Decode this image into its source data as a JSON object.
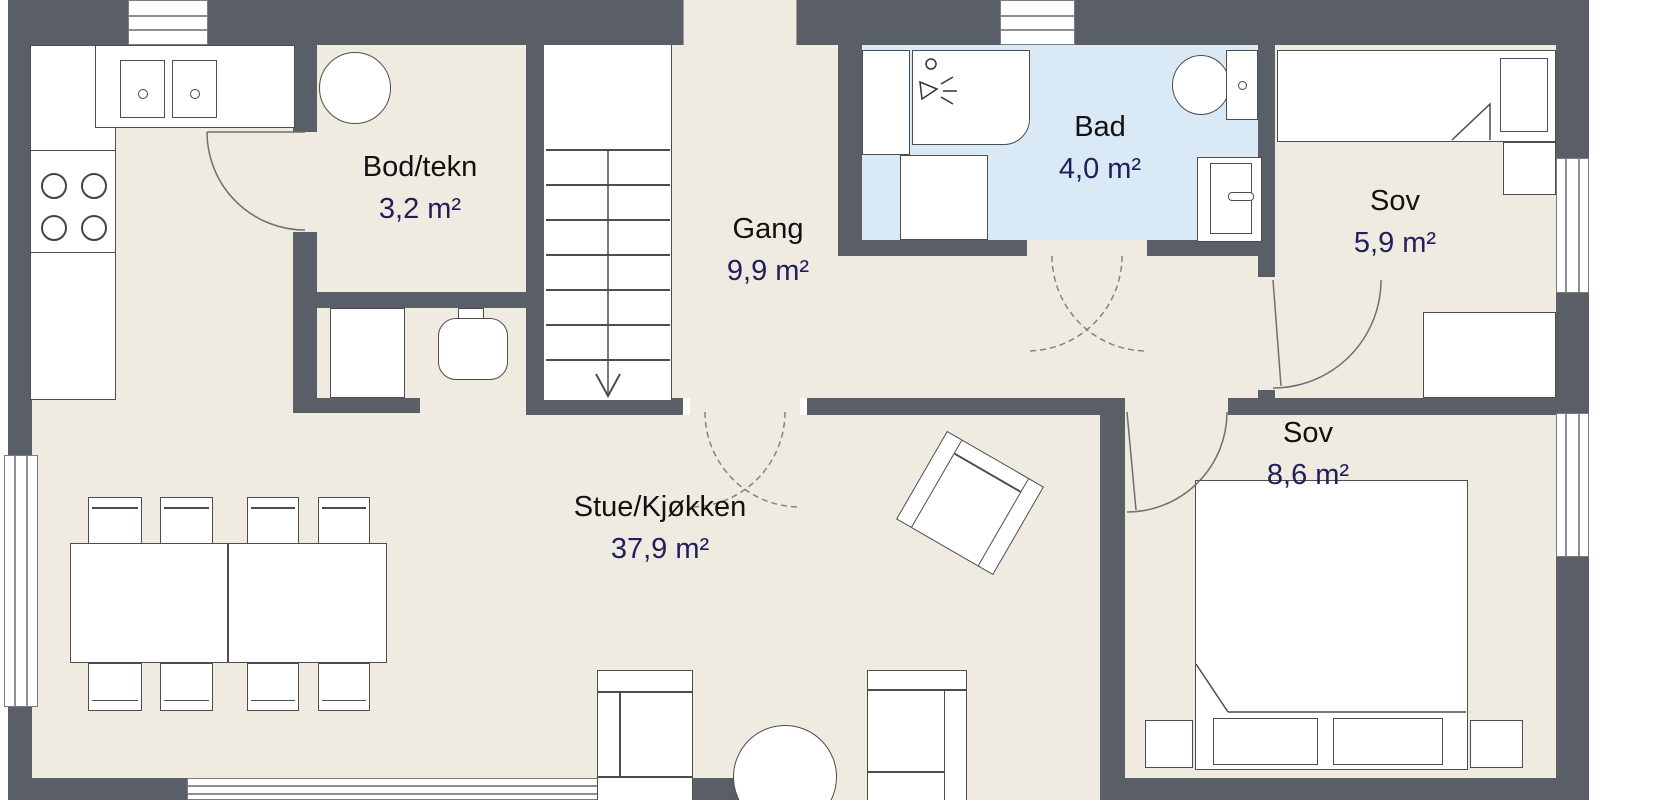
{
  "rooms": {
    "bod": {
      "name": "Bod/tekn",
      "area": "3,2 m²"
    },
    "gang": {
      "name": "Gang",
      "area": "9,9 m²"
    },
    "bad": {
      "name": "Bad",
      "area": "4,0 m²"
    },
    "sov_small": {
      "name": "Sov",
      "area": "5,9 m²"
    },
    "sov_large": {
      "name": "Sov",
      "area": "8,6 m²"
    },
    "stue": {
      "name": "Stue/Kjøkken",
      "area": "37,9 m²"
    }
  },
  "colors": {
    "wall": "#5a5f67",
    "floor": "#f0ebe0",
    "bathroom_floor": "#d9eaf6",
    "furniture_outline": "#4d4d4d",
    "room_name_text": "#111111",
    "area_text": "#20205c"
  }
}
